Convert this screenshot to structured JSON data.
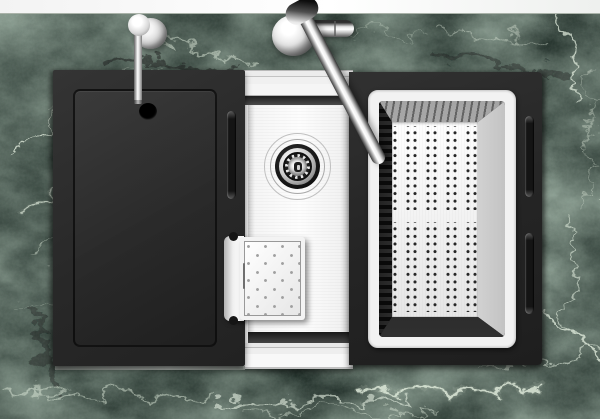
{
  "scene": {
    "type": "product-photo",
    "description": "Top-down photo of a black workstation kitchen sink set into a green marble countertop, with chrome faucet, soap dispenser, stainless basin with drain, black sliding cover board, perforated colander basket and small drip tray",
    "visible_text": ""
  },
  "parts": {
    "wall": "white wall strip",
    "countertop": "green marble countertop",
    "soap_dispenser": "chrome soap dispenser pump",
    "faucet": "chrome single-lever kitchen faucet",
    "faucet_lever": "faucet side lever handle",
    "board_cover": "black sink cover cutting board",
    "board_hole": "finger hole in cover board",
    "basin": "stainless steel sink basin",
    "drain": "sink drain strainer assembly",
    "drip_tray": "small perforated drip tray with clip bracket",
    "colander": "stainless steel perforated colander basket",
    "frame": "black sink frame right section",
    "handle_slot": "recessed grip slot"
  },
  "palette": {
    "marble_base": "#22302a",
    "marble_vein": "#dce7d8",
    "unit_black": "#272727",
    "steel_white": "#f4f4f4",
    "steel_dark": "#2e2e2e",
    "chrome_hi": "#ffffff",
    "chrome_lo": "#4e4e4e",
    "dot_dark": "#262626",
    "dot_gray": "#a0a0a0",
    "wall_white": "#fafafa"
  },
  "patterns": {
    "colander_dots": {
      "pair_columns": 4,
      "cols_per_pair": 2,
      "row_spacing_px": 7.6,
      "group_spacing_px": 20,
      "gap_band": "one blank band mid-plate"
    },
    "tray_dots": {
      "layout": "staggered diagonal grid",
      "cell_px": 17
    }
  }
}
